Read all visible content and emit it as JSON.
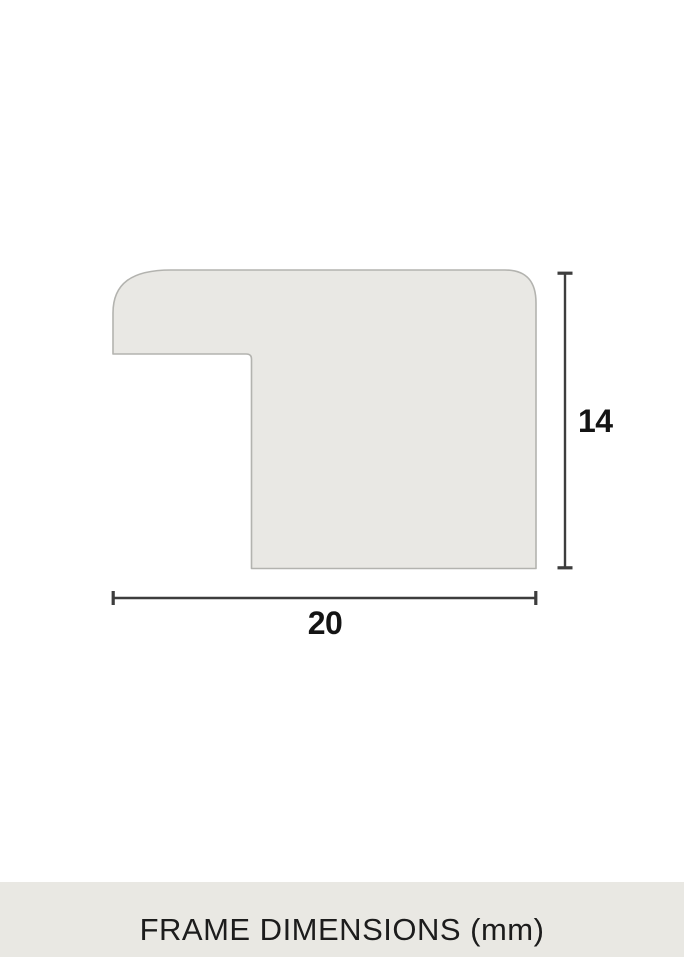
{
  "diagram": {
    "width_mm": "20",
    "height_mm": "14",
    "shape_fill": "#e9e8e4",
    "shape_stroke": "#b3b3af",
    "dimension_line_color": "#3d3d3d",
    "label_color": "#141414"
  },
  "caption": {
    "text": "FRAME DIMENSIONS (mm)",
    "background": "#e9e8e3",
    "color": "#1c1c1c"
  }
}
